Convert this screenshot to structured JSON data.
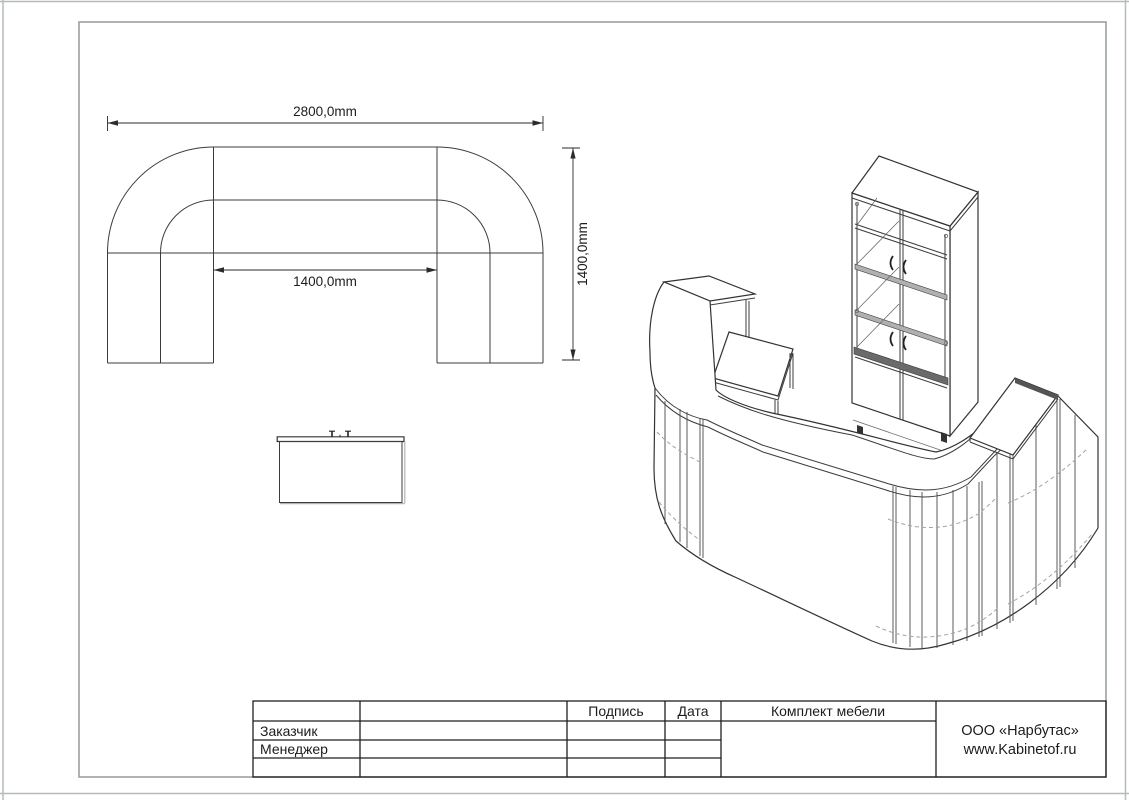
{
  "plan_view": {
    "dim_overall_width": "2800,0mm",
    "dim_overall_depth": "1400,0mm",
    "dim_inner_width": "1400,0mm"
  },
  "titleblock": {
    "signature_label": "Подпись",
    "date_label": "Дата",
    "project_title": "Комплект мебели",
    "customer_label": "Заказчик",
    "manager_label": "Менеджер",
    "company_name": "ООО «Нарбутас»",
    "company_website": "www.Kabinetof.ru"
  },
  "colors": {
    "line": "#333333",
    "sheet_border": "#9aa0a3",
    "page_edge": "#b5babd",
    "shelf_shade": "#b0b0b0",
    "band_shade": "#6a6a6a"
  }
}
